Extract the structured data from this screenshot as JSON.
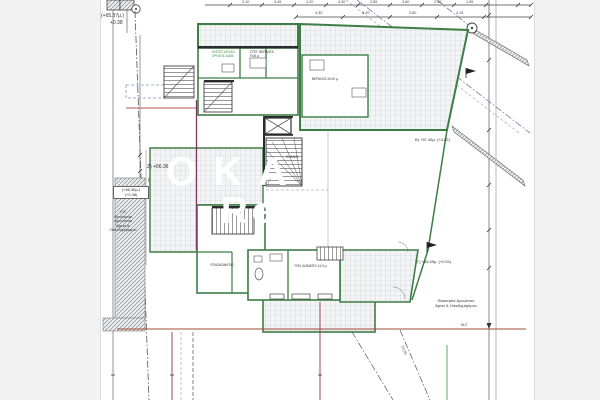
{
  "page": {
    "background": "#f2f2f3",
    "sheet_background": "#ffffff"
  },
  "colors": {
    "wall_green": "#3e7d46",
    "accent_green": "#3f8d45",
    "boundary_blue": "#6d7fa8",
    "property_red": "#9e4a3a",
    "section_maroon": "#7a3b5e",
    "red_text": "#c0392b",
    "line_dark": "#3a3a3a"
  },
  "watermark": {
    "line1": "ΟΚΑ",
    "line2": "Rea"
  },
  "levels": {
    "top_left_1": "(+65.37μ.)",
    "top_left_2": "+0.38",
    "left_mid": "Ζ) +66.36μ.)",
    "left_box_1": "(+66.36μ.)",
    "left_box_2": "(+0.38)",
    "right_upper": "Β) +57.46μ. (+4.52)",
    "right_lower": "Γ) +65.49μ. (+0.51)",
    "building_line": "Ο.Γ."
  },
  "notes": {
    "left": [
      "Υ.Π.",
      "Ιδιοκτησία",
      "Αγνώστου",
      "Άρτια & Οικοδομήσιμον"
    ],
    "right": [
      "Ιδιοκτησία Αγνώστου",
      "Άρτια & Οικοδομήσιμον"
    ]
  },
  "rooms": {
    "garden_1": "ΚΗΠΟΣ ΑΠΟΚΛ.",
    "garden_2": "ΧΡΗΣΗΣ ΔΙΑΜ.",
    "covered_1": "ΣΤΕΓ. ΒΕΡΑΝΤΑ",
    "covered_2": "9.00 μ.",
    "veranda": "ΒΕΡΑΝΤΑ 30.00 μ.",
    "stairwell": "ΚΛΙΜΑΚ.",
    "bedroom_1": "ΥΠΝΟΔΩΜΑΤΙΟ",
    "bedroom_2": "ΥΠΝ. ΔΩΜΑΤΙΟ 14.9 μ."
  },
  "dims": {
    "top": [
      "2.10",
      "3.45",
      "1.20",
      "4.30",
      "2.85",
      "3.60",
      "2.40",
      "1.95"
    ],
    "second": [
      "4.35",
      "5.20",
      "3.80",
      "4.15"
    ],
    "rotated": "15.96"
  }
}
